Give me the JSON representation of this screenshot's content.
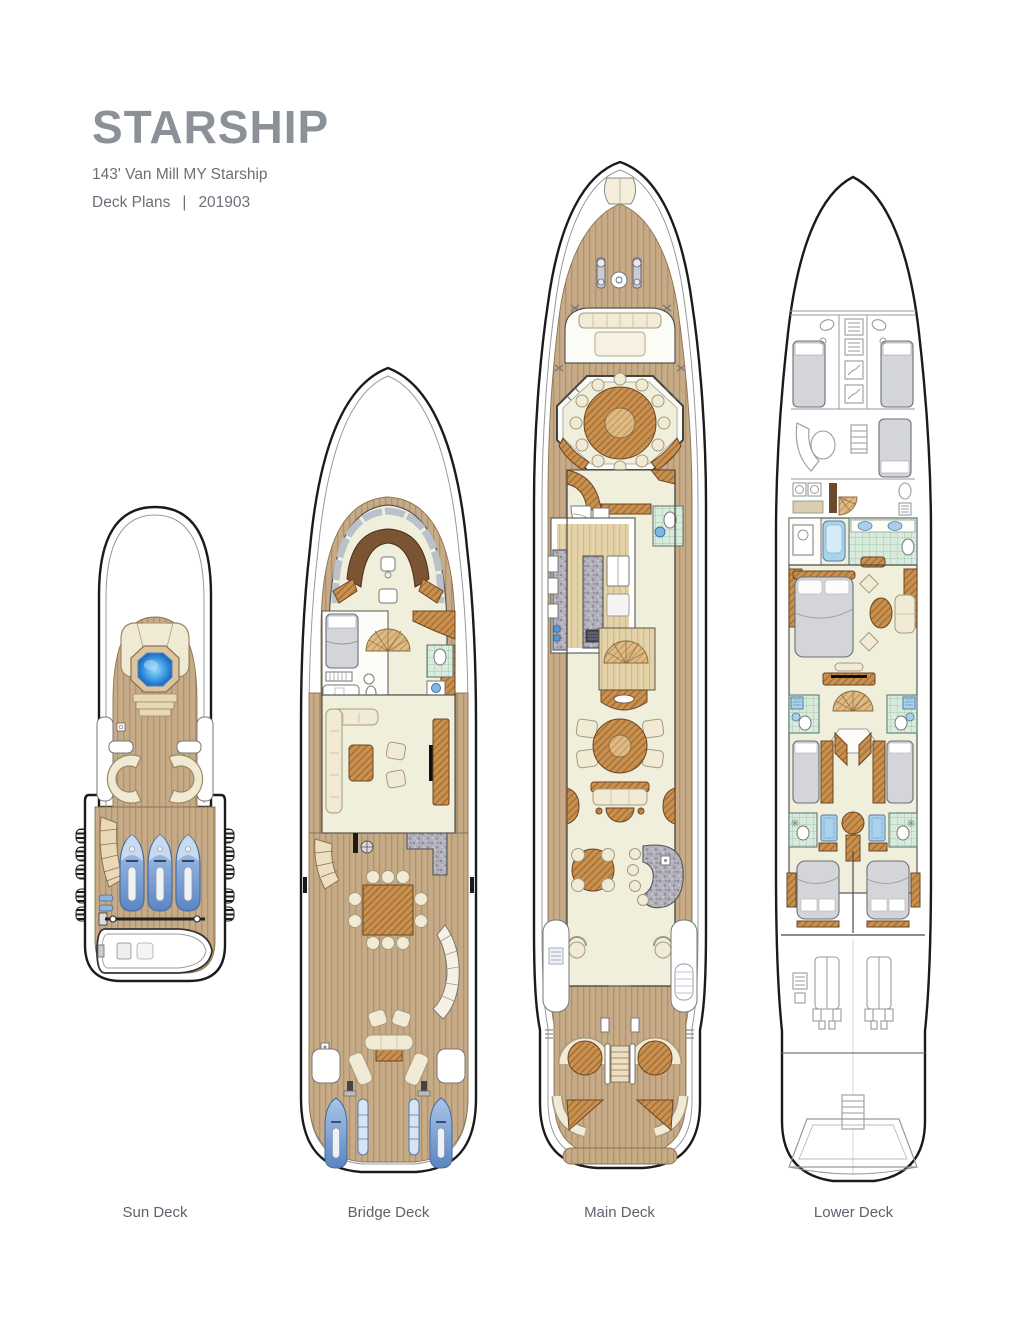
{
  "header": {
    "title": "STARSHIP",
    "subtitle": "143' Van Mill MY Starship",
    "plans_label": "Deck Plans",
    "separator": "|",
    "revision": "201903"
  },
  "decks": [
    {
      "id": "sun-deck",
      "label": "Sun Deck",
      "features": [
        "jacuzzi",
        "sun-pads",
        "c-shaped-seating-x2",
        "curved-stair",
        "jet-skis-x3",
        "crane",
        "tender-boat",
        "side-fenders"
      ]
    },
    {
      "id": "bridge-deck",
      "label": "Bridge Deck",
      "features": [
        "wheelhouse-helm",
        "captain-cabin",
        "day-head",
        "spiral-stair",
        "skylounge-sofa",
        "armchairs-x2",
        "tv-cabinet",
        "bbq-grill",
        "granite-bar",
        "al-fresco-dining-table-10-chairs",
        "lounge-chairs",
        "aft-sofa",
        "jet-skis-x2",
        "kayaks-x2"
      ]
    },
    {
      "id": "main-deck",
      "label": "Main Deck",
      "features": [
        "foredeck-windlass",
        "bow-seating",
        "octagonal-dining-room-12-chairs",
        "day-head",
        "galley",
        "spiral-stair",
        "salon-armchairs-x4",
        "salon-sofa",
        "game-table",
        "granite-bar-4-stools",
        "aft-deck-round-tables-x2",
        "transom-benches",
        "swim-platform"
      ]
    },
    {
      "id": "lower-deck",
      "label": "Lower Deck",
      "features": [
        "crew-quarters",
        "crew-mess",
        "laundry",
        "master-bathroom-tub",
        "master-stateroom",
        "spiral-stair",
        "guest-cabins-x4-ensuite",
        "engine-room-2-engines",
        "lazarette-stairs"
      ]
    }
  ],
  "colors": {
    "title_gray": "#8b9197",
    "sub_gray": "#6a7077",
    "label_gray": "#5c636d",
    "hull_outline": "#1b1b1b",
    "teak": "#c7ab86",
    "teak_stripe": "#b09070",
    "wood": "#c8914f",
    "wood_light": "#debb85",
    "floor_cream": "#f0efdc",
    "upholstery": "#f1ead5",
    "jacuzzi_blue": "#2f8fdc",
    "toy_blue": "#6f9ed8",
    "tile_green": "#d8ebdc",
    "granite_gray": "#b2b0bb",
    "bed_gray": "#d4d5d9"
  }
}
